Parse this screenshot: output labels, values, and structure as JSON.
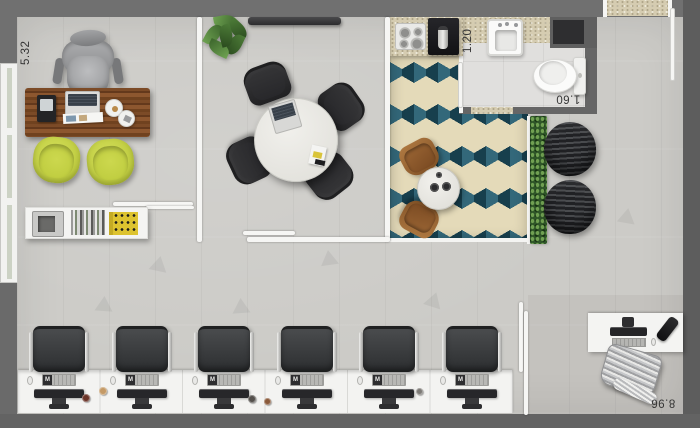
{
  "plan": {
    "type": "office-floor-plan",
    "dimension_labels": {
      "private_office_width": "5.32",
      "kitchen_width": "1.20",
      "bathroom_width": "1.60",
      "open_space_width": "8.96"
    },
    "workstation_logo": "M",
    "workstation_count": 6,
    "rooms": [
      "private-office",
      "meeting-room",
      "kitchen-dining",
      "bathroom",
      "lounge",
      "open-office",
      "manager-desk-area"
    ],
    "palette": {
      "wall_gray": "#6e6e6e",
      "floor_gray": "#cccbc7",
      "tile_cream": "#e4dab9",
      "tile_teal": "#33687a",
      "tile_dark_teal": "#173f4d",
      "guest_chair_yellow": "#c5d144",
      "desk_wood_brown": "#7c4b27",
      "hedge_green": "#2f5628",
      "marble_white": "#eceae6"
    }
  }
}
